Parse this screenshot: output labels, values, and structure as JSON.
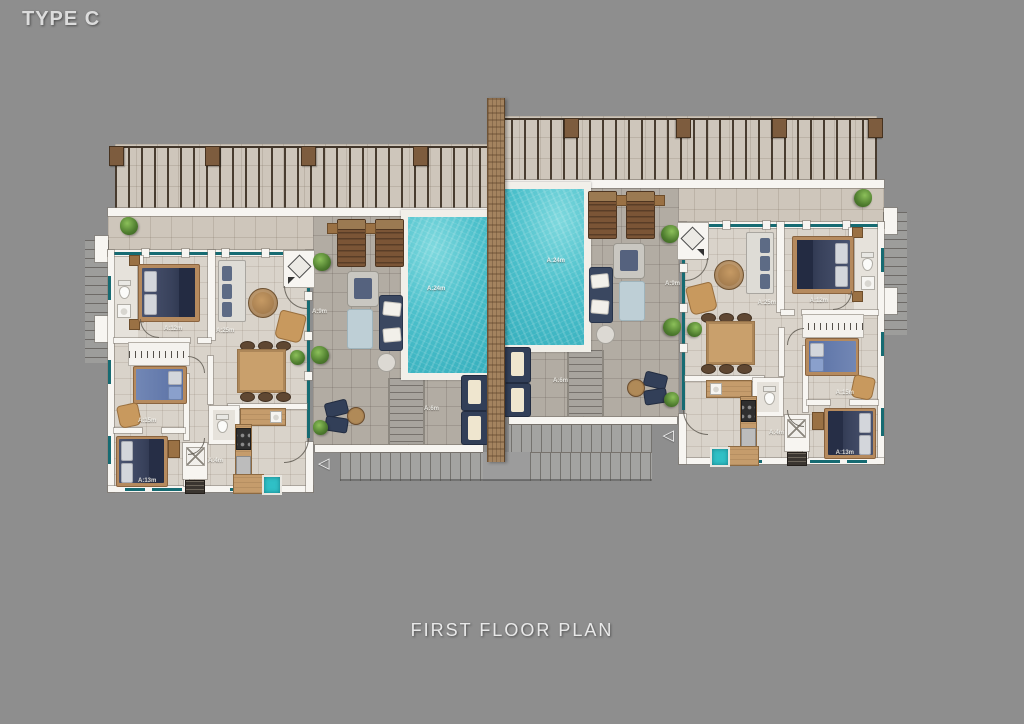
{
  "title": "TYPE C",
  "caption": "FIRST FLOOR PLAN",
  "plan": {
    "type": "residential-first-floor-plan",
    "units": 2,
    "stair_arrow_glyph": "◁",
    "room_labels": [
      {
        "room": "master-bedroom",
        "text": "A:12m"
      },
      {
        "room": "living-room",
        "text": "A:25m"
      },
      {
        "room": "bedroom-2",
        "text": "A:15m"
      },
      {
        "room": "bedroom-3",
        "text": "A:13m"
      },
      {
        "room": "hallway",
        "text": "A:4m"
      },
      {
        "room": "pool-terrace",
        "text": "A:9m"
      },
      {
        "room": "pool",
        "text": "A:24m"
      },
      {
        "room": "lower-terrace",
        "text": "A:6m"
      }
    ],
    "colors": {
      "background": "#8e8e8e",
      "wall_white": "#f7f5f1",
      "glass_teal": "#166b72",
      "pool_water": "#4cc0cb",
      "wood_divider": "#a3835f",
      "terrace_tile": "#b2aca3",
      "interior_tile": "#d9d3ca",
      "pergola_tile": "#cec6bb",
      "furniture_navy": "#3a4760",
      "furniture_wood": "#b58a5e",
      "accent_turquoise": "#2fc0c6",
      "plant_green": "#4e7c2e"
    }
  }
}
